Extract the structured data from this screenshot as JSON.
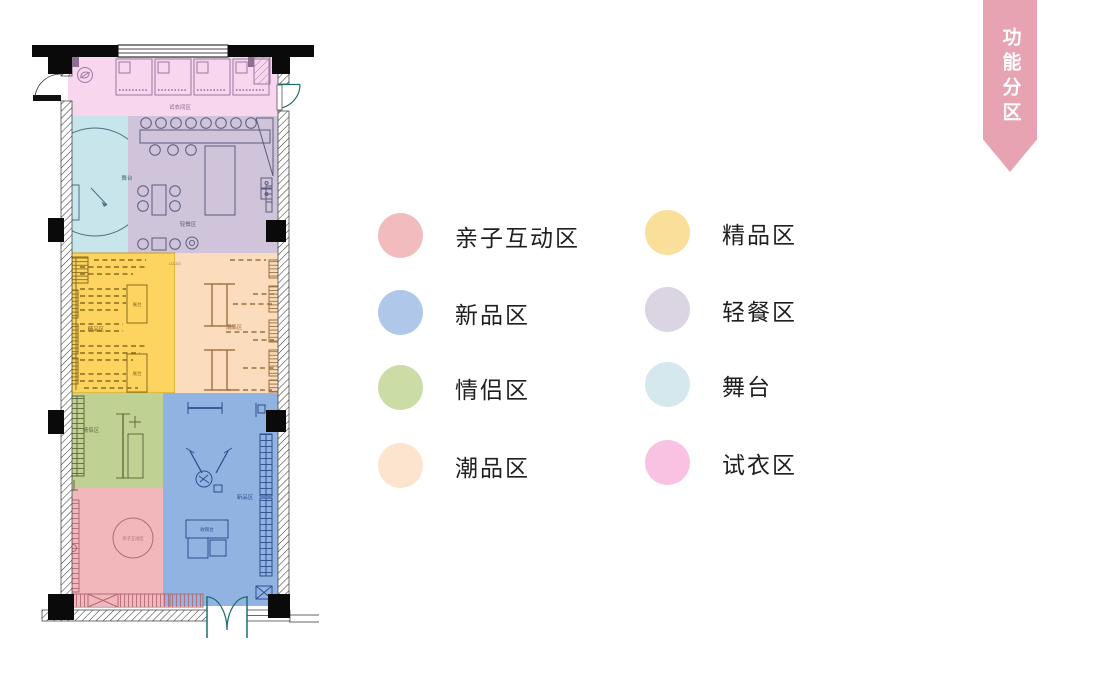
{
  "ribbon": {
    "text": "功能分区",
    "bg": "#e8a3b3"
  },
  "legend": {
    "items": [
      {
        "label": "亲子互动区",
        "color": "#f2bcbe"
      },
      {
        "label": "新品区",
        "color": "#afc7e8"
      },
      {
        "label": "情侣区",
        "color": "#cbdca6"
      },
      {
        "label": "潮品区",
        "color": "#fde4cf"
      },
      {
        "label": "精品区",
        "color": "#fadf9a"
      },
      {
        "label": "轻餐区",
        "color": "#dbd4e3"
      },
      {
        "label": "舞台",
        "color": "#d4e8ee"
      },
      {
        "label": "试衣区",
        "color": "#f9c2e2"
      }
    ]
  },
  "floor_plan": {
    "zones": [
      {
        "name": "fitting",
        "label": "试衣区",
        "color": "#f8d6ee"
      },
      {
        "name": "stage",
        "label": "舞台",
        "color": "#c7e5ea"
      },
      {
        "name": "cafe",
        "label": "轻餐区",
        "color": "#cfc4da"
      },
      {
        "name": "boutique",
        "label": "精品区",
        "color": "#fcd45f"
      },
      {
        "name": "trendy",
        "label": "潮品区",
        "color": "#fbdcbc"
      },
      {
        "name": "couple",
        "label": "情侣区",
        "color": "#c0d194"
      },
      {
        "name": "kids",
        "label": "亲子互动区",
        "color": "#f2b7ba"
      },
      {
        "name": "new",
        "label": "新品区",
        "color": "#90b3e2"
      }
    ],
    "labels": {
      "fitting": "试衣间区",
      "stage": "舞台",
      "cafe": "轻餐区",
      "logo": "LOGO",
      "boutique": "精品区",
      "display": "展台",
      "trendy": "潮品区",
      "couple": "情侣区",
      "new_products": "新品区",
      "cashier": "收银台",
      "kids": "亲子互动区"
    }
  }
}
